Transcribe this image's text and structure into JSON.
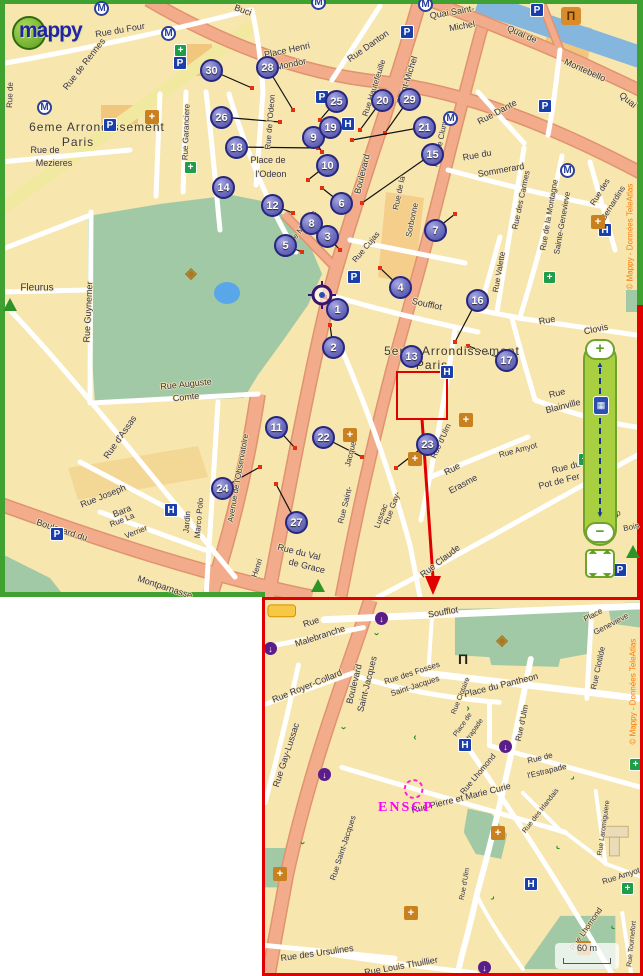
{
  "logo": {
    "text": "mappy"
  },
  "zoom_control": {
    "plus": "+",
    "minus": "−"
  },
  "main_map": {
    "copyright": "© Mappy - Données TeleAtlas",
    "markers": [
      {
        "n": "1",
        "x": 337,
        "y": 309
      },
      {
        "n": "2",
        "x": 333,
        "y": 347
      },
      {
        "n": "3",
        "x": 327,
        "y": 236
      },
      {
        "n": "4",
        "x": 400,
        "y": 287
      },
      {
        "n": "5",
        "x": 285,
        "y": 245
      },
      {
        "n": "6",
        "x": 341,
        "y": 203
      },
      {
        "n": "7",
        "x": 435,
        "y": 230
      },
      {
        "n": "8",
        "x": 311,
        "y": 223
      },
      {
        "n": "9",
        "x": 313,
        "y": 137
      },
      {
        "n": "10",
        "x": 327,
        "y": 165
      },
      {
        "n": "11",
        "x": 276,
        "y": 427
      },
      {
        "n": "12",
        "x": 272,
        "y": 205
      },
      {
        "n": "13",
        "x": 411,
        "y": 356
      },
      {
        "n": "14",
        "x": 223,
        "y": 187
      },
      {
        "n": "15",
        "x": 432,
        "y": 154
      },
      {
        "n": "16",
        "x": 477,
        "y": 300
      },
      {
        "n": "17",
        "x": 506,
        "y": 360
      },
      {
        "n": "18",
        "x": 236,
        "y": 147
      },
      {
        "n": "19",
        "x": 330,
        "y": 127
      },
      {
        "n": "20",
        "x": 382,
        "y": 100
      },
      {
        "n": "21",
        "x": 424,
        "y": 127
      },
      {
        "n": "22",
        "x": 323,
        "y": 437
      },
      {
        "n": "23",
        "x": 427,
        "y": 444
      },
      {
        "n": "24",
        "x": 222,
        "y": 488
      },
      {
        "n": "25",
        "x": 336,
        "y": 101
      },
      {
        "n": "26",
        "x": 221,
        "y": 117
      },
      {
        "n": "27",
        "x": 296,
        "y": 522
      },
      {
        "n": "28",
        "x": 267,
        "y": 67
      },
      {
        "n": "29",
        "x": 409,
        "y": 99
      },
      {
        "n": "30",
        "x": 211,
        "y": 70
      }
    ],
    "connectors": [
      {
        "n": "30",
        "x": 252,
        "y": 88
      },
      {
        "n": "28",
        "x": 293,
        "y": 110
      },
      {
        "n": "26",
        "x": 280,
        "y": 122
      },
      {
        "n": "18",
        "x": 318,
        "y": 148
      },
      {
        "n": "25",
        "x": 320,
        "y": 120
      },
      {
        "n": "19",
        "x": 318,
        "y": 138
      },
      {
        "n": "9",
        "x": 322,
        "y": 152
      },
      {
        "n": "10",
        "x": 308,
        "y": 180
      },
      {
        "n": "20",
        "x": 360,
        "y": 130
      },
      {
        "n": "29",
        "x": 385,
        "y": 133
      },
      {
        "n": "21",
        "x": 352,
        "y": 140
      },
      {
        "n": "15",
        "x": 362,
        "y": 203
      },
      {
        "n": "6",
        "x": 322,
        "y": 188
      },
      {
        "n": "8",
        "x": 332,
        "y": 234
      },
      {
        "n": "3",
        "x": 340,
        "y": 250
      },
      {
        "n": "12",
        "x": 293,
        "y": 213
      },
      {
        "n": "5",
        "x": 302,
        "y": 252
      },
      {
        "n": "4",
        "x": 380,
        "y": 268
      },
      {
        "n": "2",
        "x": 330,
        "y": 325
      },
      {
        "n": "1",
        "x": 325,
        "y": 297
      },
      {
        "n": "16",
        "x": 455,
        "y": 342
      },
      {
        "n": "17",
        "x": 468,
        "y": 346
      },
      {
        "n": "22",
        "x": 362,
        "y": 457
      },
      {
        "n": "23",
        "x": 396,
        "y": 468
      },
      {
        "n": "24",
        "x": 260,
        "y": 467
      },
      {
        "n": "27",
        "x": 276,
        "y": 484
      },
      {
        "n": "11",
        "x": 295,
        "y": 448
      },
      {
        "n": "7",
        "x": 455,
        "y": 214
      }
    ],
    "labels": [
      {
        "t": "Rue du Four",
        "x": 120,
        "y": 30,
        "r": -10
      },
      {
        "t": "Rue de Rennes",
        "x": 84,
        "y": 64,
        "r": -52
      },
      {
        "t": "Buci",
        "x": 243,
        "y": 10,
        "r": 20
      },
      {
        "t": "6eme Arrondissement",
        "x": 97,
        "y": 127,
        "r": 0,
        "c": "district"
      },
      {
        "t": "Paris",
        "x": 78,
        "y": 142,
        "r": 0,
        "c": "district"
      },
      {
        "t": "Rue de",
        "x": 45,
        "y": 150
      },
      {
        "t": "Mezieres",
        "x": 54,
        "y": 163
      },
      {
        "t": "Rue Garanciere",
        "x": 186,
        "y": 132,
        "r": -88,
        "s": 8
      },
      {
        "t": "Place Henri",
        "x": 287,
        "y": 50,
        "r": -12
      },
      {
        "t": "Mondor",
        "x": 291,
        "y": 64,
        "r": -12
      },
      {
        "t": "Rue Danton",
        "x": 368,
        "y": 46,
        "r": -35
      },
      {
        "t": "Rue Hautefeuille",
        "x": 374,
        "y": 88,
        "r": -72,
        "s": 8
      },
      {
        "t": "Saint-Michel",
        "x": 407,
        "y": 80,
        "r": -72
      },
      {
        "t": "Boulevard",
        "x": 362,
        "y": 174,
        "r": -76
      },
      {
        "t": "Quai Saint-",
        "x": 452,
        "y": 12,
        "r": -10
      },
      {
        "t": "Michel",
        "x": 462,
        "y": 26,
        "r": -10
      },
      {
        "t": "Quai de",
        "x": 522,
        "y": 34,
        "r": 24
      },
      {
        "t": "Montebello",
        "x": 585,
        "y": 70,
        "r": 24
      },
      {
        "t": "Quai",
        "x": 628,
        "y": 100,
        "r": 40
      },
      {
        "t": "Rue Dante",
        "x": 497,
        "y": 112,
        "r": -28
      },
      {
        "t": "Rue du",
        "x": 477,
        "y": 155,
        "r": -10
      },
      {
        "t": "Sommerard",
        "x": 501,
        "y": 170,
        "r": -10
      },
      {
        "t": "Rue de Cluny",
        "x": 440,
        "y": 143,
        "r": -78,
        "s": 8
      },
      {
        "t": "Rue de la",
        "x": 399,
        "y": 193,
        "r": -78,
        "s": 8
      },
      {
        "t": "Sorbonne",
        "x": 412,
        "y": 220,
        "r": -78,
        "s": 8
      },
      {
        "t": "Rue de l'Odeon",
        "x": 270,
        "y": 122,
        "r": -85,
        "s": 8
      },
      {
        "t": "Place de",
        "x": 268,
        "y": 160
      },
      {
        "t": "l'Odeon",
        "x": 271,
        "y": 174
      },
      {
        "t": "Rue de Medicis",
        "x": 298,
        "y": 233,
        "r": -52,
        "s": 8
      },
      {
        "t": "Rue Cujas",
        "x": 366,
        "y": 247,
        "r": -50,
        "s": 8
      },
      {
        "t": "Soufflot",
        "x": 427,
        "y": 304,
        "r": 12
      },
      {
        "t": "5eme Arrondissement",
        "x": 452,
        "y": 351,
        "c": "district"
      },
      {
        "t": "Paris",
        "x": 432,
        "y": 365,
        "c": "district"
      },
      {
        "t": "Rue Valette",
        "x": 499,
        "y": 272,
        "r": -80,
        "s": 8
      },
      {
        "t": "Rue des Carmes",
        "x": 521,
        "y": 200,
        "r": -78,
        "s": 8
      },
      {
        "t": "Rue de la Montagne",
        "x": 549,
        "y": 215,
        "r": -80,
        "s": 8
      },
      {
        "t": "Sainte-Genevieve",
        "x": 562,
        "y": 223,
        "r": -80,
        "s": 8
      },
      {
        "t": "Rue des",
        "x": 600,
        "y": 192,
        "r": -58,
        "s": 8
      },
      {
        "t": "Bernardins",
        "x": 613,
        "y": 203,
        "r": -58,
        "s": 8
      },
      {
        "t": "Rue",
        "x": 547,
        "y": 320,
        "r": -10
      },
      {
        "t": "Clovis",
        "x": 596,
        "y": 329,
        "r": -12
      },
      {
        "t": "Rue",
        "x": 557,
        "y": 393,
        "r": -14
      },
      {
        "t": "Blainville",
        "x": 563,
        "y": 406,
        "r": -14
      },
      {
        "t": "Rue Amyot",
        "x": 518,
        "y": 450,
        "r": -15,
        "s": 8
      },
      {
        "t": "Rue du",
        "x": 566,
        "y": 467,
        "r": -14
      },
      {
        "t": "Pot de Fer",
        "x": 559,
        "y": 481,
        "r": -14
      },
      {
        "t": "Rue",
        "x": 452,
        "y": 469,
        "r": -28
      },
      {
        "t": "Erasme",
        "x": 463,
        "y": 484,
        "r": -28
      },
      {
        "t": "Rue d'Ulm",
        "x": 441,
        "y": 441,
        "r": -65,
        "s": 8
      },
      {
        "t": "Rue Claude",
        "x": 440,
        "y": 561,
        "r": -38
      },
      {
        "t": "l'Ep",
        "x": 614,
        "y": 514,
        "r": -12,
        "s": 8
      },
      {
        "t": "Bois",
        "x": 631,
        "y": 527,
        "r": -12,
        "s": 8
      },
      {
        "t": "Rue Gay-",
        "x": 392,
        "y": 508,
        "r": -70,
        "s": 8
      },
      {
        "t": "Lussac",
        "x": 381,
        "y": 516,
        "r": -70,
        "s": 8
      },
      {
        "t": "Rue Saint-",
        "x": 345,
        "y": 505,
        "r": -76,
        "s": 8
      },
      {
        "t": "Jacques",
        "x": 351,
        "y": 452,
        "r": -76,
        "s": 8
      },
      {
        "t": "Fleurus",
        "x": 37,
        "y": 288,
        "s": 10
      },
      {
        "t": "Rue Guynemer",
        "x": 88,
        "y": 312,
        "r": -87
      },
      {
        "t": "Rue Auguste",
        "x": 186,
        "y": 384,
        "r": -6
      },
      {
        "t": "Comte",
        "x": 186,
        "y": 397,
        "r": -6
      },
      {
        "t": "Rue d'Assas",
        "x": 120,
        "y": 437,
        "r": -55
      },
      {
        "t": "Rue Joseph",
        "x": 103,
        "y": 496,
        "r": -22
      },
      {
        "t": "Bara",
        "x": 122,
        "y": 511,
        "r": -22
      },
      {
        "t": "Rue La",
        "x": 122,
        "y": 520,
        "r": -22,
        "s": 8
      },
      {
        "t": "Verrier",
        "x": 136,
        "y": 532,
        "r": -22,
        "s": 8
      },
      {
        "t": "Jardin",
        "x": 187,
        "y": 522,
        "r": -85,
        "s": 8
      },
      {
        "t": "Marco Polo",
        "x": 199,
        "y": 518,
        "r": -85,
        "s": 8
      },
      {
        "t": "Avenue de l'Observatoire",
        "x": 238,
        "y": 478,
        "r": -80,
        "s": 8
      },
      {
        "t": "Boulevard du",
        "x": 62,
        "y": 530,
        "r": 18
      },
      {
        "t": "Montparnasse",
        "x": 165,
        "y": 587,
        "r": 18
      },
      {
        "t": "Rue du Val",
        "x": 299,
        "y": 552,
        "r": 14
      },
      {
        "t": "de Grace",
        "x": 307,
        "y": 566,
        "r": 14
      },
      {
        "t": "Henri",
        "x": 257,
        "y": 568,
        "r": -72,
        "s": 8
      },
      {
        "t": "Rue de",
        "x": 10,
        "y": 95,
        "r": -88,
        "s": 8
      }
    ],
    "icons": [
      {
        "k": "metro",
        "x": 101,
        "y": 8
      },
      {
        "k": "metro",
        "x": 168,
        "y": 33
      },
      {
        "k": "metro",
        "x": 44,
        "y": 107
      },
      {
        "k": "metro",
        "x": 450,
        "y": 118
      },
      {
        "k": "metro",
        "x": 567,
        "y": 170
      },
      {
        "k": "metro",
        "x": 425,
        "y": 4
      },
      {
        "k": "metro",
        "x": 318,
        "y": 2
      },
      {
        "k": "parking",
        "x": 110,
        "y": 125
      },
      {
        "k": "parking",
        "x": 180,
        "y": 63
      },
      {
        "k": "parking",
        "x": 322,
        "y": 97
      },
      {
        "k": "parking",
        "x": 354,
        "y": 277
      },
      {
        "k": "parking",
        "x": 537,
        "y": 10
      },
      {
        "k": "parking",
        "x": 407,
        "y": 32
      },
      {
        "k": "parking",
        "x": 545,
        "y": 106
      },
      {
        "k": "parking",
        "x": 57,
        "y": 534
      },
      {
        "k": "parking",
        "x": 620,
        "y": 570
      },
      {
        "k": "hospital",
        "x": 348,
        "y": 124
      },
      {
        "k": "hospital",
        "x": 447,
        "y": 372
      },
      {
        "k": "hospital",
        "x": 605,
        "y": 230
      },
      {
        "k": "hospital",
        "x": 171,
        "y": 510
      },
      {
        "k": "pharmacy",
        "x": 181,
        "y": 51
      },
      {
        "k": "pharmacy",
        "x": 191,
        "y": 168
      },
      {
        "k": "pharmacy",
        "x": 550,
        "y": 278
      },
      {
        "k": "pharmacy",
        "x": 585,
        "y": 460
      },
      {
        "k": "church",
        "x": 152,
        "y": 117
      },
      {
        "k": "church",
        "x": 350,
        "y": 435
      },
      {
        "k": "church",
        "x": 415,
        "y": 459
      },
      {
        "k": "church",
        "x": 466,
        "y": 420
      },
      {
        "k": "church",
        "x": 598,
        "y": 222
      },
      {
        "k": "museum",
        "x": 568,
        "y": 14
      },
      {
        "k": "compass",
        "x": 190,
        "y": 272
      },
      {
        "k": "tree",
        "x": 10,
        "y": 305
      },
      {
        "k": "tree",
        "x": 318,
        "y": 586
      },
      {
        "k": "tree",
        "x": 633,
        "y": 552
      }
    ]
  },
  "inset": {
    "copyright": "© Mappy - Données TeleAtlas",
    "enscp": "ENSCP",
    "scale_text": "60 m",
    "labels": [
      {
        "t": "Soufflot",
        "x": 178,
        "y": 12,
        "r": -10
      },
      {
        "t": "Rue",
        "x": 46,
        "y": 22,
        "r": -18
      },
      {
        "t": "Malebranche",
        "x": 55,
        "y": 36,
        "r": -18
      },
      {
        "t": "Rue Royer-Collard",
        "x": 42,
        "y": 86,
        "r": -22
      },
      {
        "t": "Rue Gay-Lussac",
        "x": 21,
        "y": 155,
        "r": -72
      },
      {
        "t": "Boulevard",
        "x": 89,
        "y": 84,
        "r": -76
      },
      {
        "t": "Saint-Jacques",
        "x": 102,
        "y": 84,
        "r": -76
      },
      {
        "t": "Rue des Fosses",
        "x": 147,
        "y": 73,
        "r": -18,
        "s": 8
      },
      {
        "t": "Saint-Jacques",
        "x": 150,
        "y": 86,
        "r": -18,
        "s": 8
      },
      {
        "t": "Place du Pantheon",
        "x": 236,
        "y": 85,
        "r": -14
      },
      {
        "t": "Place",
        "x": 328,
        "y": 15,
        "r": -28,
        "s": 8
      },
      {
        "t": "Genevieve",
        "x": 346,
        "y": 24,
        "r": -28,
        "s": 8
      },
      {
        "t": "Rue Clotilde",
        "x": 333,
        "y": 68,
        "r": -78,
        "s": 8
      },
      {
        "t": "Rue Clotaire",
        "x": 196,
        "y": 96,
        "r": -68,
        "s": 7
      },
      {
        "t": "Rue d'Ulm",
        "x": 257,
        "y": 123,
        "r": -78,
        "s": 8
      },
      {
        "t": "Place de",
        "x": 198,
        "y": 125,
        "r": -55,
        "s": 7
      },
      {
        "t": "l'Estrapade",
        "x": 207,
        "y": 134,
        "r": -55,
        "s": 7
      },
      {
        "t": "Rue de",
        "x": 275,
        "y": 158,
        "r": -14,
        "s": 8
      },
      {
        "t": "l'Estrapade",
        "x": 282,
        "y": 171,
        "r": -14,
        "s": 8
      },
      {
        "t": "Rue Lhomond",
        "x": 213,
        "y": 174,
        "r": -50,
        "s": 8
      },
      {
        "t": "Rue des Irlandais",
        "x": 276,
        "y": 211,
        "r": -52,
        "s": 7
      },
      {
        "t": "Rue Pierre et Marie Curie",
        "x": 196,
        "y": 198,
        "r": -14
      },
      {
        "t": "Rue Laromiguiere",
        "x": 339,
        "y": 228,
        "r": -82,
        "s": 7
      },
      {
        "t": "Rue Amyot",
        "x": 356,
        "y": 276,
        "r": -18,
        "s": 8
      },
      {
        "t": "Rue Lhomond",
        "x": 321,
        "y": 329,
        "r": -55,
        "s": 8
      },
      {
        "t": "Rue Tournefort",
        "x": 367,
        "y": 344,
        "r": -84,
        "s": 7
      },
      {
        "t": "Rue d'Ulm",
        "x": 200,
        "y": 284,
        "r": -80,
        "s": 7
      },
      {
        "t": "Rue des Ursulines",
        "x": 52,
        "y": 353,
        "r": -8
      },
      {
        "t": "Rue Louis Thuillier",
        "x": 136,
        "y": 366,
        "r": -10
      },
      {
        "t": "Rue Saint-Jacques",
        "x": 78,
        "y": 248,
        "r": -72,
        "s": 8
      }
    ],
    "icons": [
      {
        "k": "hospital",
        "x": 200,
        "y": 145
      },
      {
        "k": "hospital",
        "x": 266,
        "y": 284
      },
      {
        "k": "church",
        "x": 233,
        "y": 233
      },
      {
        "k": "church",
        "x": 319,
        "y": 348
      },
      {
        "k": "church",
        "x": 15,
        "y": 274
      },
      {
        "k": "church",
        "x": 146,
        "y": 313
      },
      {
        "k": "pharmacy",
        "x": 371,
        "y": 165
      },
      {
        "k": "pharmacy",
        "x": 363,
        "y": 289
      },
      {
        "k": "oneway",
        "x": 117,
        "y": 19
      },
      {
        "k": "oneway",
        "x": 6,
        "y": 49
      },
      {
        "k": "oneway",
        "x": 60,
        "y": 175
      },
      {
        "k": "oneway",
        "x": 241,
        "y": 147
      },
      {
        "k": "oneway",
        "x": 220,
        "y": 368
      },
      {
        "k": "monument",
        "x": 196,
        "y": 59
      },
      {
        "k": "compass",
        "x": 236,
        "y": 39
      },
      {
        "k": "greenarrow",
        "x": 114,
        "y": 36,
        "r": 90
      },
      {
        "k": "greenarrow",
        "x": 81,
        "y": 130,
        "r": 90
      },
      {
        "k": "greenarrow",
        "x": 40,
        "y": 245,
        "r": 90
      },
      {
        "k": "greenarrow",
        "x": 205,
        "y": 110,
        "r": 0
      },
      {
        "k": "greenarrow",
        "x": 152,
        "y": 140,
        "r": 180
      },
      {
        "k": "greenarrow",
        "x": 310,
        "y": 180,
        "r": 45
      },
      {
        "k": "greenarrow",
        "x": 295,
        "y": 250,
        "r": 135
      },
      {
        "k": "greenarrow",
        "x": 230,
        "y": 300,
        "r": 45
      },
      {
        "k": "greenarrow",
        "x": 350,
        "y": 330,
        "r": 135
      }
    ]
  }
}
